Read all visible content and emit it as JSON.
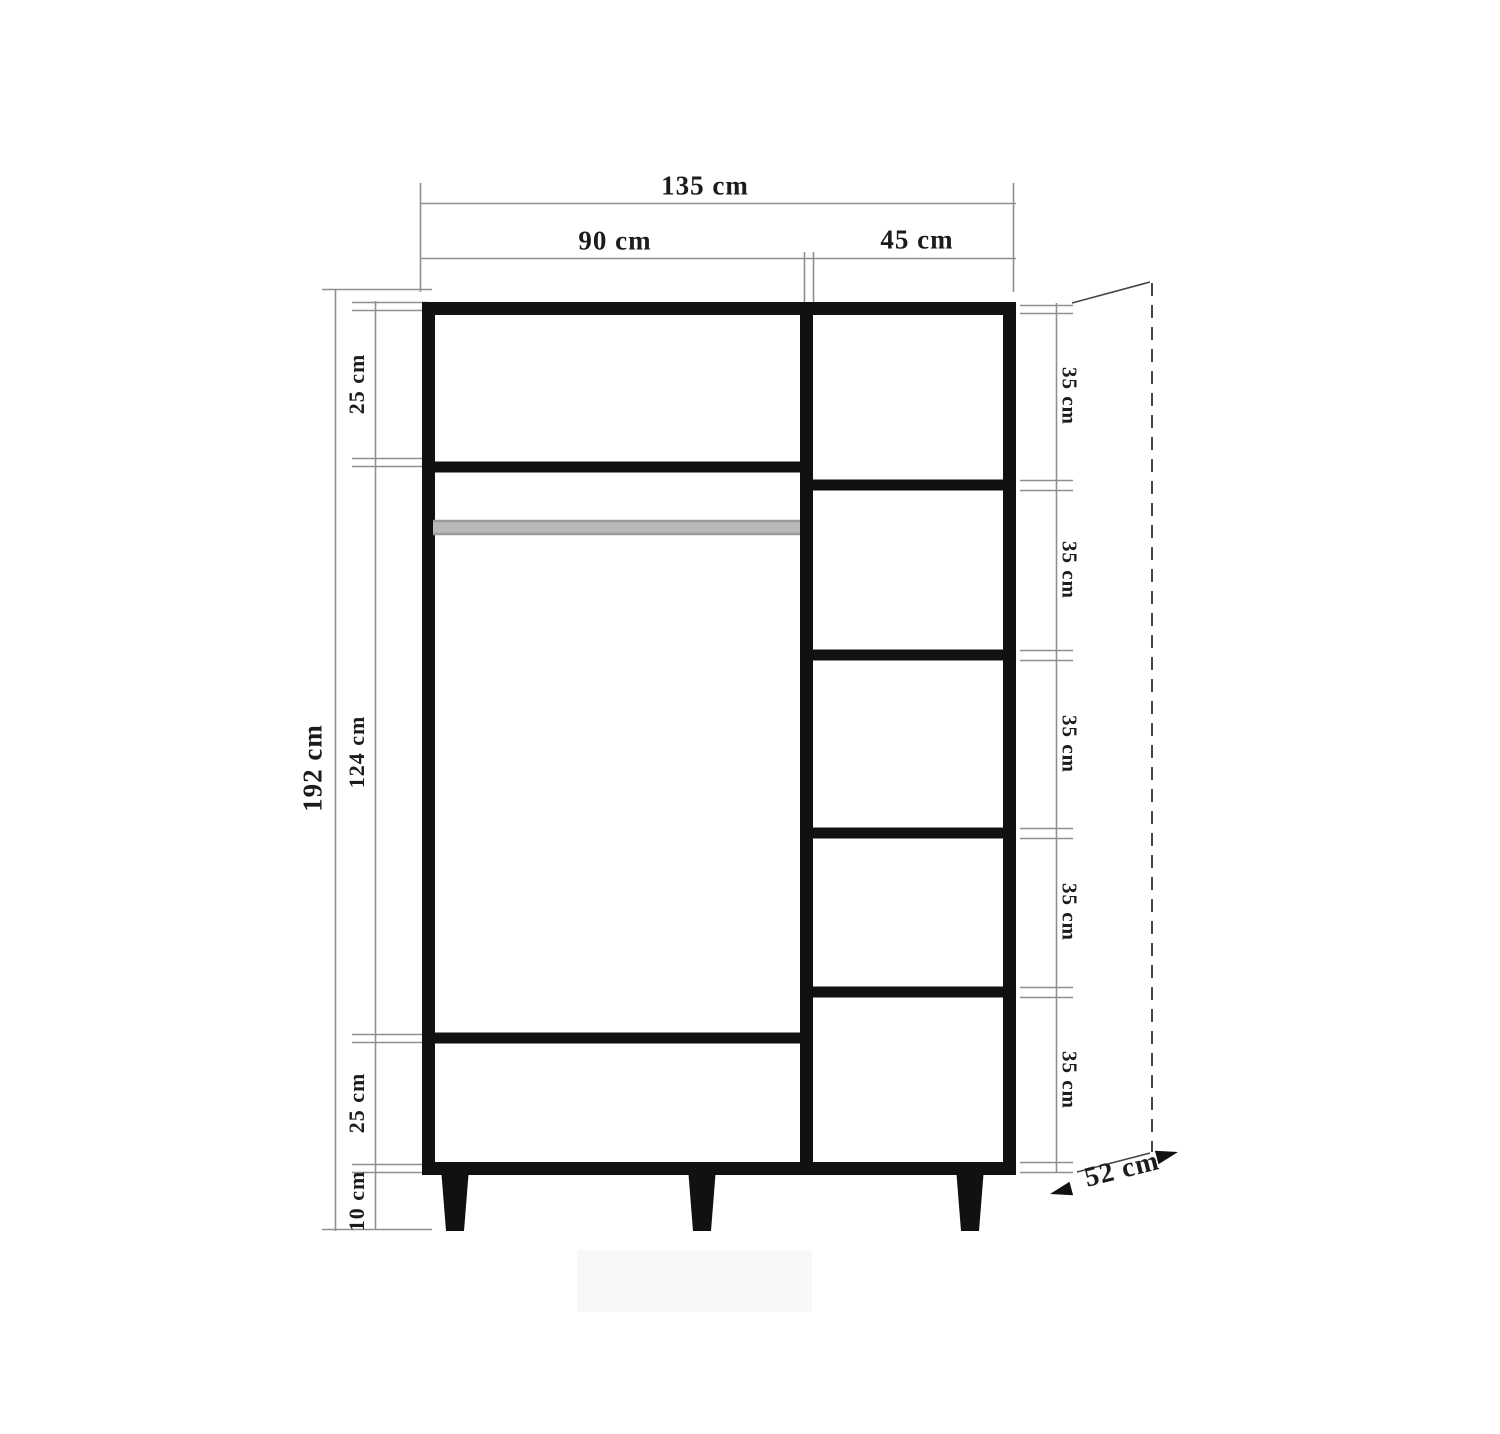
{
  "diagram": {
    "type": "furniture-technical-drawing",
    "subject": "wardrobe front elevation with dimensions",
    "labels": {
      "total_width": "135 cm",
      "left_section_width": "90 cm",
      "right_section_width": "45 cm",
      "total_height": "192 cm",
      "top_compartment_height": "25 cm",
      "hanging_section_height": "124 cm",
      "bottom_compartment_height": "25 cm",
      "leg_height": "10 cm",
      "shelf_heights": [
        "35 cm",
        "35 cm",
        "35 cm",
        "35 cm",
        "35 cm"
      ],
      "depth": "52 cm"
    },
    "colors": {
      "structure": "#111111",
      "dimension_lines": "#8f8f8f",
      "depth_lines": "#474747",
      "hanging_rod": "#b8b8b8",
      "text": "#1c1c1c",
      "background": "#ffffff"
    }
  }
}
